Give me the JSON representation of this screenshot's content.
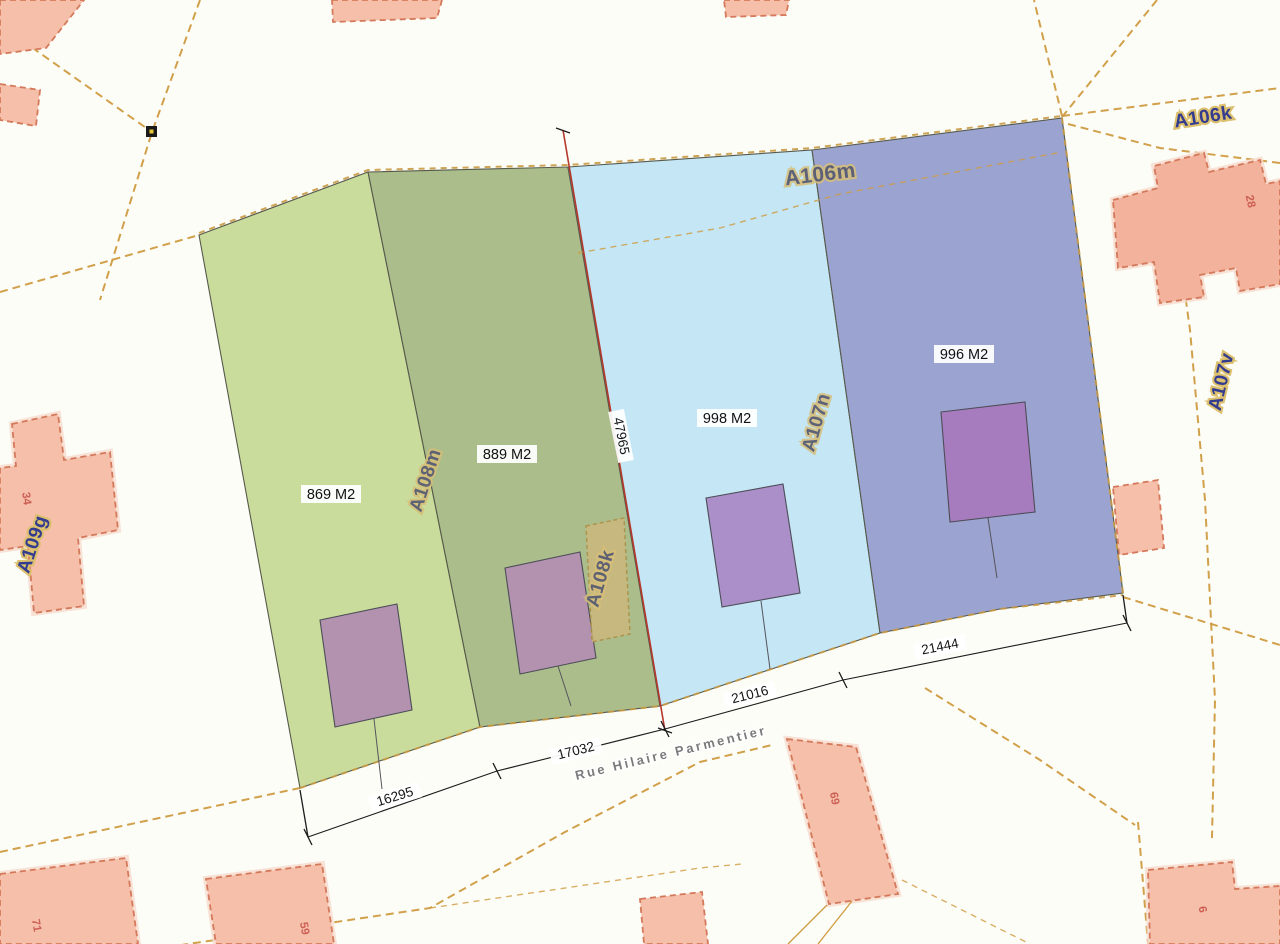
{
  "map_title": "cadastral-parcel-plan",
  "street": {
    "name": "Rue Hilaire Parmentier"
  },
  "parcel_labels": {
    "a109g": "A109g",
    "a108m": "A108m",
    "a108k": "A108k",
    "a106m": "A106m",
    "a106k": "A106k",
    "a107n": "A107n",
    "a107v": "A107v"
  },
  "areas": {
    "plot1": "869 M2",
    "plot2": "889 M2",
    "plot3": "998 M2",
    "plot4": "996 M2"
  },
  "dimensions": {
    "d1": "16295",
    "d2": "17032",
    "d3": "21016",
    "d4": "21444",
    "d5": "47965"
  },
  "house_numbers": {
    "h34": "34",
    "h28": "28",
    "h71": "71",
    "h59": "59",
    "h69": "69",
    "h6": "6"
  },
  "colors": {
    "parcel_light_green": "#c9dc9b",
    "parcel_dark_green": "#abbd8b",
    "parcel_light_blue": "#c4e6f5",
    "parcel_dark_blue": "#9ba3d0",
    "building_mauve": "#b292ae",
    "building_purple_light_blue_plot": "#aa8fc9",
    "building_purple_dark_blue_plot": "#a77cbe",
    "building_salmon": "#f5bfa9",
    "salmon_border": "#d4795b",
    "road_dash": "#cf9b40",
    "survey_red_line": "#b5382c",
    "parcel_code_text": "#333c8f",
    "parcel_code_halo": "#dcc06e",
    "street_text": "#7b7b7b",
    "house_number_text": "#c9564c"
  }
}
